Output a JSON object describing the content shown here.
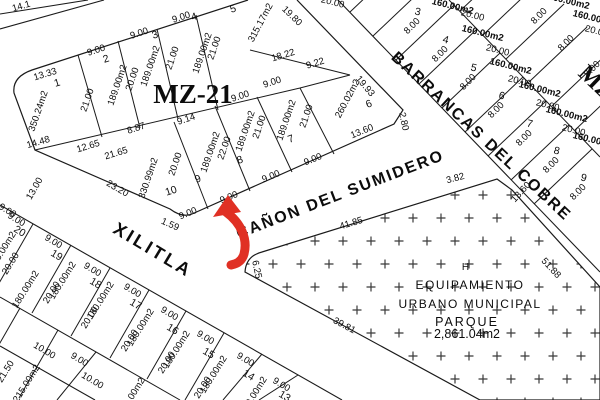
{
  "map_title": "MZ-21",
  "blocks": [
    {
      "label": "MZ-21"
    },
    {
      "label": "MZ"
    }
  ],
  "streets": [
    {
      "name": "XILITLA"
    },
    {
      "name": "CAÑON DEL SUMIDERO"
    },
    {
      "name": "BARRANCAS DEL COBRE"
    }
  ],
  "park": {
    "lines": [
      "H",
      "EQUIPAMIENTO",
      "URBANO MUNICIPAL",
      "PARQUE",
      "2,861.04m2"
    ],
    "edge_dimensions": [
      "41.85",
      "3.82",
      "51.88",
      "39.81",
      "6.25"
    ]
  },
  "highlight": {
    "type": "arrow",
    "color": "#e03024"
  },
  "labels": [
    {
      "t": "XILITLA",
      "x": 150,
      "y": 255,
      "r": 31,
      "s": 18,
      "ls": 3,
      "w": 600,
      "n": "street-name-xilitla"
    },
    {
      "t": "CAÑON DEL SUMIDERO",
      "x": 342,
      "y": 199,
      "r": -21,
      "s": 16,
      "ls": 2,
      "w": 600,
      "n": "street-name-canon-del-sumidero"
    },
    {
      "t": "BARRANCAS DEL COBRE",
      "x": 478,
      "y": 140,
      "r": 43,
      "s": 16,
      "ls": 2,
      "w": 600,
      "n": "street-name-barrancas-del-cobre"
    },
    {
      "t": "MZ-21",
      "x": 193,
      "y": 103,
      "r": 0,
      "s": 27,
      "w": 700,
      "serif": true,
      "n": "block-label-mz21"
    },
    {
      "t": "MZ",
      "x": 591,
      "y": 88,
      "r": 44,
      "s": 24,
      "w": 700,
      "serif": true,
      "n": "block-label-mz"
    },
    {
      "t": "H",
      "x": 466,
      "y": 270,
      "r": 0,
      "s": 10,
      "ls": 1,
      "n": "park-label"
    },
    {
      "t": "EQUIPAMIENTO",
      "x": 470,
      "y": 289,
      "r": 0,
      "s": 12,
      "ls": 1.5,
      "n": "park-label"
    },
    {
      "t": "URBANO MUNICIPAL",
      "x": 470,
      "y": 308,
      "r": 0,
      "s": 12,
      "ls": 1.5,
      "n": "park-label"
    },
    {
      "t": "PARQUE",
      "x": 467,
      "y": 326,
      "r": 0,
      "s": 12.5,
      "ls": 2,
      "n": "park-label"
    },
    {
      "t": "2,861.04m2",
      "x": 467,
      "y": 338,
      "r": 0,
      "s": 12.5,
      "n": "park-area-label"
    },
    {
      "t": "41.85",
      "x": 352,
      "y": 226,
      "r": -17
    },
    {
      "t": "3.82",
      "x": 456,
      "y": 181,
      "r": -15
    },
    {
      "t": "51.88",
      "x": 549,
      "y": 270,
      "r": 47
    },
    {
      "t": "39.81",
      "x": 343,
      "y": 328,
      "r": 28
    },
    {
      "t": "6.25",
      "x": 254,
      "y": 270,
      "r": 78
    },
    {
      "t": "14.1",
      "x": 22,
      "y": 9,
      "r": -16
    },
    {
      "t": "13.33",
      "x": 46,
      "y": 77,
      "r": -17
    },
    {
      "t": "1",
      "x": 58,
      "y": 86,
      "r": -17,
      "s": 10.5,
      "n": "lot-number"
    },
    {
      "t": "350.24m2",
      "x": 41,
      "y": 112,
      "r": -71
    },
    {
      "t": "21.00",
      "x": 90,
      "y": 101,
      "r": -71
    },
    {
      "t": "9.00",
      "x": 97,
      "y": 53,
      "r": -18
    },
    {
      "t": "2",
      "x": 107,
      "y": 62,
      "r": -18,
      "s": 10.5,
      "n": "lot-number"
    },
    {
      "t": "189.00m2",
      "x": 120,
      "y": 86,
      "r": -71
    },
    {
      "t": "20.00",
      "x": 135,
      "y": 80,
      "r": -71
    },
    {
      "t": "9.00",
      "x": 140,
      "y": 36,
      "r": -18
    },
    {
      "t": "3",
      "x": 156,
      "y": 38,
      "r": -18,
      "s": 10.5,
      "n": "lot-number"
    },
    {
      "t": "189.00m2",
      "x": 153,
      "y": 67,
      "r": -71
    },
    {
      "t": "21.00",
      "x": 175,
      "y": 59,
      "r": -71
    },
    {
      "t": "9.00",
      "x": 182,
      "y": 20,
      "r": -18
    },
    {
      "t": "4",
      "x": 195,
      "y": 20,
      "r": -18,
      "s": 10.5,
      "n": "lot-number"
    },
    {
      "t": "189.00m2",
      "x": 205,
      "y": 54,
      "r": -71
    },
    {
      "t": "21.00",
      "x": 217,
      "y": 49,
      "r": -71
    },
    {
      "t": "5",
      "x": 234,
      "y": 12,
      "r": -18,
      "s": 10.5,
      "n": "lot-number"
    },
    {
      "t": "315.17m2",
      "x": 263,
      "y": 24,
      "r": -62
    },
    {
      "t": "19.80",
      "x": 290,
      "y": 18,
      "r": 44
    },
    {
      "t": "18.22",
      "x": 284,
      "y": 58,
      "r": -17
    },
    {
      "t": "9.22",
      "x": 316,
      "y": 66,
      "r": -17
    },
    {
      "t": "9.00",
      "x": 241,
      "y": 99,
      "r": -18
    },
    {
      "t": "9.00",
      "x": 273,
      "y": 85,
      "r": -18
    },
    {
      "t": "19.93",
      "x": 363,
      "y": 88,
      "r": 50
    },
    {
      "t": "260.02m2",
      "x": 350,
      "y": 100,
      "r": -62
    },
    {
      "t": "6",
      "x": 370,
      "y": 107,
      "r": -20,
      "s": 10.5,
      "n": "lot-number"
    },
    {
      "t": "13.60",
      "x": 363,
      "y": 134,
      "r": -22
    },
    {
      "t": "2.80",
      "x": 401,
      "y": 122,
      "r": 78
    },
    {
      "t": "14.48",
      "x": 39,
      "y": 145,
      "r": -16
    },
    {
      "t": "12.65",
      "x": 89,
      "y": 149,
      "r": -17
    },
    {
      "t": "21.65",
      "x": 117,
      "y": 156,
      "r": -17
    },
    {
      "t": "8.87",
      "x": 137,
      "y": 131,
      "r": -18
    },
    {
      "t": "9.14",
      "x": 187,
      "y": 122,
      "r": -18
    },
    {
      "t": "330.99m2",
      "x": 151,
      "y": 179,
      "r": -71
    },
    {
      "t": "20.00",
      "x": 178,
      "y": 165,
      "r": -71
    },
    {
      "t": "10",
      "x": 172,
      "y": 194,
      "r": -18,
      "s": 10.5,
      "n": "lot-number"
    },
    {
      "t": "23.20",
      "x": 116,
      "y": 191,
      "r": 30
    },
    {
      "t": "13.00",
      "x": 37,
      "y": 190,
      "r": -60
    },
    {
      "t": "1.59",
      "x": 169,
      "y": 227,
      "r": 24
    },
    {
      "t": "9.00",
      "x": 189,
      "y": 216,
      "r": -22
    },
    {
      "t": "189.00m2",
      "x": 213,
      "y": 153,
      "r": -71
    },
    {
      "t": "22.00",
      "x": 227,
      "y": 149,
      "r": -71
    },
    {
      "t": "9",
      "x": 199,
      "y": 182,
      "r": -20,
      "s": 10.5,
      "n": "lot-number"
    },
    {
      "t": "9.00",
      "x": 230,
      "y": 200,
      "r": -22
    },
    {
      "t": "189.00m2",
      "x": 248,
      "y": 132,
      "r": -71
    },
    {
      "t": "21.00",
      "x": 262,
      "y": 128,
      "r": -71
    },
    {
      "t": "8",
      "x": 241,
      "y": 163,
      "r": -20,
      "s": 10.5,
      "n": "lot-number"
    },
    {
      "t": "9.00",
      "x": 272,
      "y": 179,
      "r": -22
    },
    {
      "t": "189.00m2",
      "x": 289,
      "y": 121,
      "r": -71
    },
    {
      "t": "21.00",
      "x": 309,
      "y": 117,
      "r": -71
    },
    {
      "t": "7",
      "x": 292,
      "y": 142,
      "r": -20,
      "s": 10.5,
      "n": "lot-number"
    },
    {
      "t": "9.00",
      "x": 314,
      "y": 162,
      "r": -22
    },
    {
      "t": "8.00",
      "x": 414,
      "y": 28,
      "r": -45
    },
    {
      "t": "8.00",
      "x": 442,
      "y": 56,
      "r": -45
    },
    {
      "t": "8.00",
      "x": 470,
      "y": 84,
      "r": -45
    },
    {
      "t": "8.00",
      "x": 498,
      "y": 112,
      "r": -45
    },
    {
      "t": "8.00",
      "x": 526,
      "y": 140,
      "r": -45
    },
    {
      "t": "8.00",
      "x": 553,
      "y": 167,
      "r": -45
    },
    {
      "t": "8.00",
      "x": 580,
      "y": 194,
      "r": -45
    },
    {
      "t": "3",
      "x": 417,
      "y": 15,
      "r": 14,
      "s": 10.5,
      "n": "lot-number"
    },
    {
      "t": "4",
      "x": 445,
      "y": 43,
      "r": 14,
      "s": 10.5,
      "n": "lot-number"
    },
    {
      "t": "5",
      "x": 473,
      "y": 71,
      "r": 14,
      "s": 10.5,
      "n": "lot-number"
    },
    {
      "t": "6",
      "x": 501,
      "y": 99,
      "r": 14,
      "s": 10.5,
      "n": "lot-number"
    },
    {
      "t": "7",
      "x": 529,
      "y": 127,
      "r": 14,
      "s": 10.5,
      "n": "lot-number"
    },
    {
      "t": "8",
      "x": 556,
      "y": 154,
      "r": 14,
      "s": 10.5,
      "n": "lot-number"
    },
    {
      "t": "9",
      "x": 583,
      "y": 181,
      "r": 14,
      "s": 10.5,
      "n": "lot-number"
    },
    {
      "t": "160.00m2",
      "x": 452,
      "y": 9,
      "r": 14,
      "w": 700
    },
    {
      "t": "160.00m2",
      "x": 482,
      "y": 36,
      "r": 14,
      "w": 700
    },
    {
      "t": "160.00m2",
      "x": 510,
      "y": 69,
      "r": 14,
      "w": 700
    },
    {
      "t": "160.00m2",
      "x": 539,
      "y": 92,
      "r": 14,
      "w": 700
    },
    {
      "t": "160.00m2",
      "x": 566,
      "y": 117,
      "r": 14,
      "w": 700
    },
    {
      "t": "160.00m2",
      "x": 593,
      "y": 143,
      "r": 14,
      "w": 700
    },
    {
      "t": "20.00",
      "x": 472,
      "y": 18,
      "r": 14
    },
    {
      "t": "20.00",
      "x": 497,
      "y": 53,
      "r": 14
    },
    {
      "t": "20.00",
      "x": 519,
      "y": 84,
      "r": 14
    },
    {
      "t": "20.00",
      "x": 547,
      "y": 108,
      "r": 14
    },
    {
      "t": "20.00",
      "x": 573,
      "y": 133,
      "r": 14
    },
    {
      "t": "20.00",
      "x": 332,
      "y": 5,
      "r": 14
    },
    {
      "t": "160.00m2",
      "x": 568,
      "y": 4,
      "r": 14,
      "w": 700
    },
    {
      "t": "8.00",
      "x": 541,
      "y": 18,
      "r": -45
    },
    {
      "t": "8.00",
      "x": 568,
      "y": 45,
      "r": -45
    },
    {
      "t": "8.00",
      "x": 594,
      "y": 71,
      "r": -45
    },
    {
      "t": "160.00m2",
      "x": 593,
      "y": 21,
      "r": 14,
      "w": 700
    },
    {
      "t": "20.00",
      "x": 596,
      "y": 34,
      "r": 14
    },
    {
      "t": "13.60",
      "x": 523,
      "y": 194,
      "r": -47
    },
    {
      "t": "9.00",
      "x": 15,
      "y": 222,
      "r": 31
    },
    {
      "t": "20",
      "x": 18,
      "y": 234,
      "r": 31,
      "s": 10.5,
      "n": "lot-number"
    },
    {
      "t": "180.00m2",
      "x": 28,
      "y": 291,
      "r": -58
    },
    {
      "t": "20.00",
      "x": 13,
      "y": 265,
      "r": -58
    },
    {
      "t": "9.00",
      "x": 52,
      "y": 244,
      "r": 31
    },
    {
      "t": "19",
      "x": 55,
      "y": 258,
      "r": 31,
      "s": 10.5,
      "n": "lot-number"
    },
    {
      "t": "180.00m2",
      "x": 65,
      "y": 282,
      "r": -58
    },
    {
      "t": "20.00",
      "x": 54,
      "y": 294,
      "r": -58
    },
    {
      "t": "9.00",
      "x": 91,
      "y": 272,
      "r": 31
    },
    {
      "t": "18",
      "x": 94,
      "y": 286,
      "r": 31,
      "s": 10.5,
      "n": "lot-number"
    },
    {
      "t": "180.00m2",
      "x": 103,
      "y": 302,
      "r": -58
    },
    {
      "t": "20.00",
      "x": 92,
      "y": 319,
      "r": -58
    },
    {
      "t": "9.00",
      "x": 131,
      "y": 293,
      "r": 31
    },
    {
      "t": "17",
      "x": 134,
      "y": 307,
      "r": 31,
      "s": 10.5,
      "n": "lot-number"
    },
    {
      "t": "180.00m2",
      "x": 143,
      "y": 329,
      "r": -58
    },
    {
      "t": "20.00",
      "x": 132,
      "y": 342,
      "r": -58
    },
    {
      "t": "9.00",
      "x": 168,
      "y": 316,
      "r": 31
    },
    {
      "t": "16",
      "x": 171,
      "y": 332,
      "r": 31,
      "s": 10.5,
      "n": "lot-number"
    },
    {
      "t": "180.00m2",
      "x": 179,
      "y": 351,
      "r": -58
    },
    {
      "t": "20.00",
      "x": 169,
      "y": 364,
      "r": -58
    },
    {
      "t": "9.00",
      "x": 204,
      "y": 340,
      "r": 31
    },
    {
      "t": "15",
      "x": 207,
      "y": 356,
      "r": 31,
      "s": 10.5,
      "n": "lot-number"
    },
    {
      "t": "180.00m2",
      "x": 216,
      "y": 376,
      "r": -58
    },
    {
      "t": "20.00",
      "x": 205,
      "y": 389,
      "r": -58
    },
    {
      "t": "9.00",
      "x": 244,
      "y": 362,
      "r": 31
    },
    {
      "t": "14",
      "x": 247,
      "y": 378,
      "r": 31,
      "s": 10.5,
      "n": "lot-number"
    },
    {
      "t": "180.00m2",
      "x": 256,
      "y": 397,
      "r": -58
    },
    {
      "t": "9.00",
      "x": 280,
      "y": 387,
      "r": 31
    },
    {
      "t": "13",
      "x": 283,
      "y": 399,
      "r": 31,
      "s": 10.5,
      "n": "lot-number"
    },
    {
      "t": "9.00",
      "x": 6,
      "y": 213,
      "r": 31
    },
    {
      "t": "180.00m2",
      "x": 5,
      "y": 252,
      "r": -58
    },
    {
      "t": "10.00",
      "x": 43,
      "y": 353,
      "r": 31
    },
    {
      "t": "9.00",
      "x": 78,
      "y": 362,
      "r": 31
    },
    {
      "t": "10.00",
      "x": 91,
      "y": 383,
      "r": 31
    },
    {
      "t": "21.50",
      "x": 8,
      "y": 373,
      "r": -58
    },
    {
      "t": "215.00m2",
      "x": 29,
      "y": 385,
      "r": -58
    },
    {
      "t": "180.00m2",
      "x": 134,
      "y": 398,
      "r": -58
    }
  ]
}
